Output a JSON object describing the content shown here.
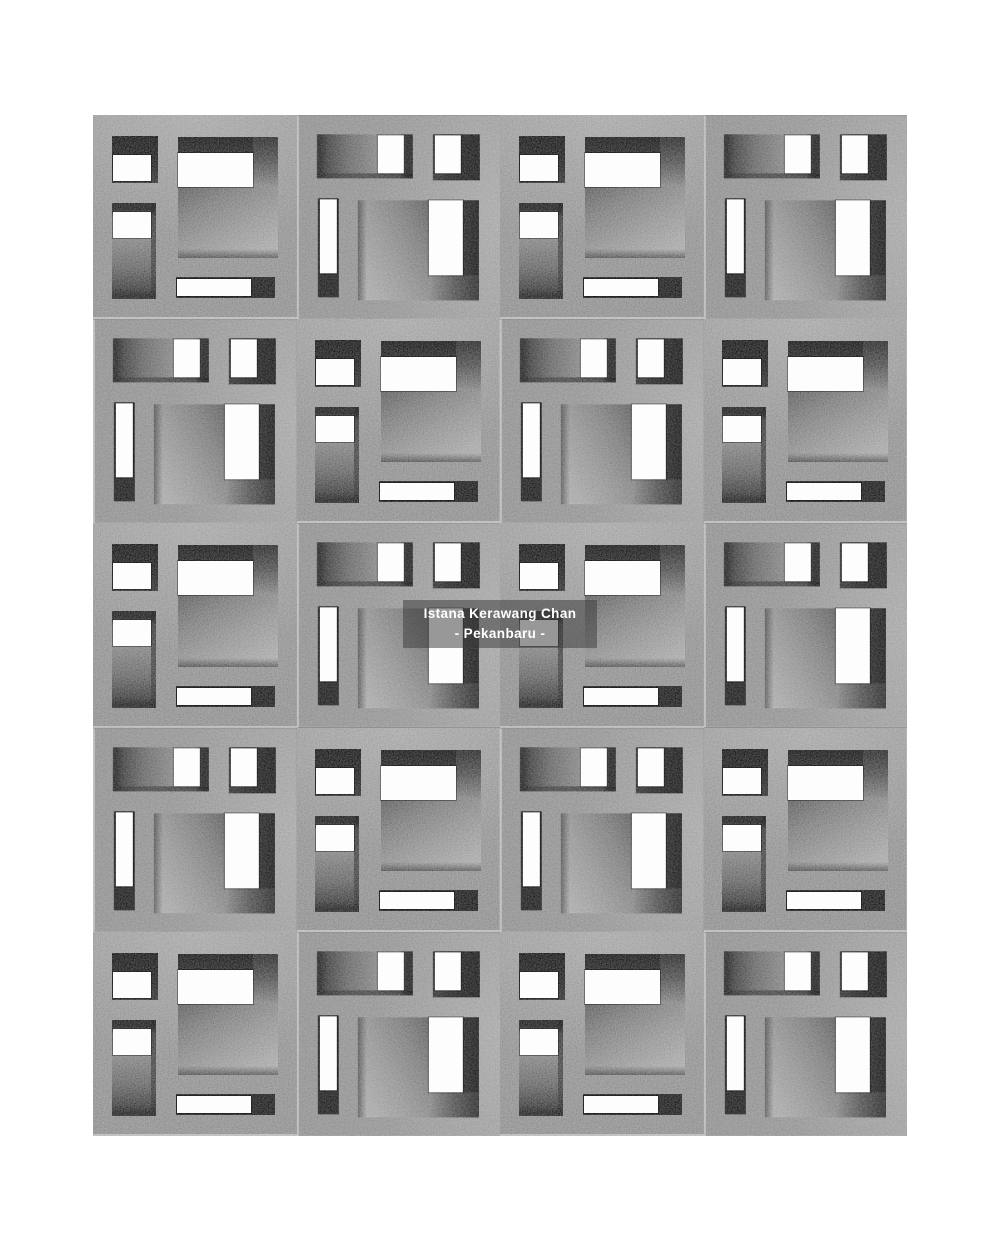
{
  "canvas": {
    "width": 1001,
    "height": 1251,
    "background": "#ffffff"
  },
  "caption": {
    "line1": "Istana Kerawang Chan",
    "line2": "- Pekanbaru -",
    "left": 403,
    "top": 600,
    "width": 194,
    "height": 48,
    "background": "rgba(60,60,60,0.52)",
    "text_color": "#ffffff"
  },
  "montage": {
    "left": 93,
    "top": 115,
    "width": 814,
    "height": 1021,
    "rows": 5,
    "cols": 4,
    "concrete_color": "#8d8d8d",
    "seam_color": "rgba(255,255,255,0.38)",
    "arrangement": "checkerboard of one breeze-block photo and the same photo rotated 90 degrees clockwise"
  },
  "block_pattern": {
    "unit": 204,
    "openings": [
      {
        "name": "small-top-recess",
        "style": "hole-a",
        "x": 19,
        "y": 21,
        "w": 46,
        "h": 47,
        "children": [
          {
            "cls": "white",
            "x": 1,
            "y": 19,
            "w": 38,
            "h": 26
          }
        ]
      },
      {
        "name": "main-opening",
        "style": "hole-main",
        "x": 85,
        "y": 22,
        "w": 100,
        "h": 121,
        "children": [
          {
            "cls": "band",
            "x": 0,
            "y": 0,
            "w": 100,
            "h": 16
          },
          {
            "cls": "wall",
            "x": 75,
            "y": 0,
            "w": 25,
            "h": 50
          },
          {
            "cls": "white",
            "x": 0,
            "y": 16,
            "w": 75,
            "h": 34
          },
          {
            "cls": "sill",
            "x": 0,
            "y": 112,
            "w": 100,
            "h": 9
          }
        ]
      },
      {
        "name": "side-slot",
        "style": "hole-slot",
        "x": 19,
        "y": 88,
        "w": 44,
        "h": 96,
        "children": [
          {
            "cls": "wall-r",
            "x": 39,
            "y": 0,
            "w": 5,
            "h": 96
          },
          {
            "cls": "white",
            "x": 1,
            "y": 9,
            "w": 38,
            "h": 26
          }
        ]
      },
      {
        "name": "bottom-slot",
        "style": "hole-b",
        "x": 83,
        "y": 162,
        "w": 99,
        "h": 21,
        "children": [
          {
            "cls": "white",
            "x": 1,
            "y": 2,
            "w": 74,
            "h": 17
          }
        ]
      }
    ]
  }
}
